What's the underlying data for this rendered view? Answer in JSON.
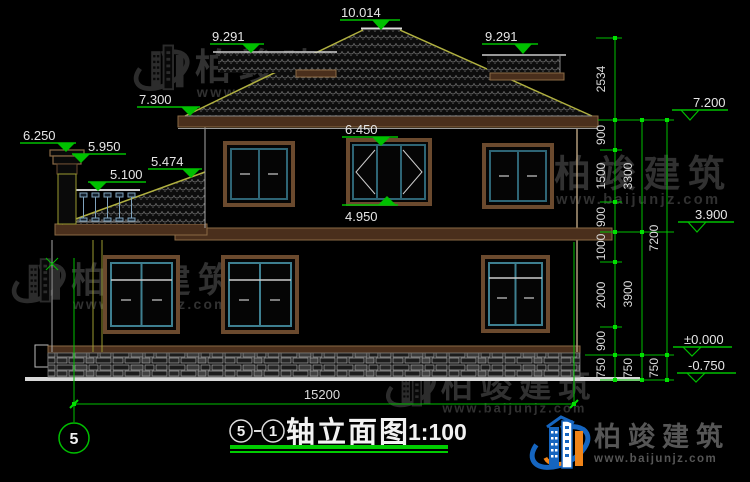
{
  "drawing": {
    "title": {
      "axis_from": "5",
      "axis_to": "1",
      "name": "轴立面图",
      "scale": "1:100"
    },
    "axis_bubble": {
      "label": "5"
    }
  },
  "elevation_marks": [
    "10.014",
    "9.291",
    "9.291",
    "7.300",
    "6.250",
    "5.950",
    "5.474",
    "5.100",
    "6.450",
    "4.950",
    "7.200",
    "3.900",
    "±0.000",
    "-0.750"
  ],
  "dims": {
    "overall_width": "15200",
    "right_inner": [
      "2534",
      "900",
      "1500",
      "900",
      "1000",
      "2000",
      "900",
      "750"
    ],
    "right_middle": [
      "3300",
      "3900",
      "750"
    ],
    "right_outer": [
      "7200",
      "750"
    ]
  },
  "watermark": {
    "name": "柏竣建筑",
    "url": "www.baijunjz.com"
  },
  "logo": {
    "name": "柏竣建筑",
    "url": "www.baijunjz.com"
  },
  "colors": {
    "background": "#000000",
    "dimension_green": "#00C000",
    "node_green": "#00E000",
    "text_white": "#E6E6E6",
    "trim_brown": "#4A2F1C",
    "trim_brown_edge": "#8A6A45",
    "window_teal": "#2E6575",
    "roof_edge_olive": "#B0B040",
    "stone_gray": "#9A9A9A",
    "logo_blue": "#1565C0",
    "logo_orange": "#F08418"
  }
}
